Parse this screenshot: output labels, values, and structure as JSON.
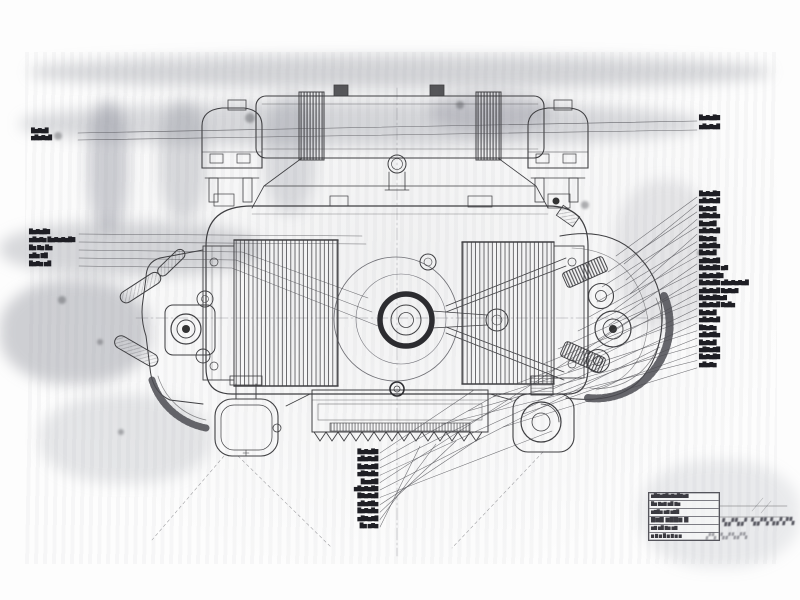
{
  "sheet": {
    "colors": {
      "paper": "#fdfdfd",
      "ink": "#3f3f42",
      "label_ink": "#1e1e24",
      "smudge": "#8c8f98"
    }
  },
  "annotations": {
    "left_top_labels": [
      "█▆▇▆█",
      "▆█▆▇▆█"
    ],
    "left_labels": [
      "█▆▇▆█▇",
      "▆█▆▇▆ █▆▇▆▇▆█▇",
      "█▆ ▇▆ █▆",
      "▆█▆ ▇█",
      "█▆▇▆ ▆█"
    ],
    "right_top_labels": [
      "█▆▇▆█▇",
      "▆█▆▇▆█"
    ],
    "right_labels": [
      "█▆▇▆█▇",
      "▆█▆▇▆█",
      "█▆▇▆▇",
      "▆█▇▆█▆",
      "█▆▆▇█",
      "▆█▆▇▆█",
      "█▇▆▇▆",
      "▆█▆▇█▆",
      "█▆▇▆█",
      "▆█▇▆▇█",
      "█▆▇▆█▇ ▆▇",
      "▆█▆▇▆█▇",
      "█▆▇▆█▇ ▆█▆▇▆▇▆█",
      "▆█▆▇▆█ ▇▆▇▆▇",
      "█▆▇▆█▇▆▇",
      "▆█▆▇▆█ ▇▆█▆",
      "█▆▇▆█",
      "▆█▆▇▆█",
      "█▇▆▇▆",
      "▆█▆▇█▆",
      "█▆▇▆█",
      "▆█▇▆▇█",
      "█▆▇▆█▇",
      "▆█▆▇▆"
    ],
    "bottom_labels": [
      "█▆▇▆█▇",
      "▆█▆▇▆█",
      "█▆▇▆▇█",
      "▆█▇▆█▆",
      "█▆▆▇█",
      "▆█▆▇▆█▇",
      "█▇▆▇▆█",
      "▆█▆▇█▆",
      "█▆▇▆█▆",
      "▆█▇▆▇█",
      "█▆ ▆▇▆"
    ]
  },
  "title_block": {
    "rows": [
      "▆█▇▆▇█▆▇▆█▇▆▇",
      "█▆ ▇▆▇ ▆█ ▇▆",
      "▆▇█▆ ▆▇ ▆▇█",
      "█▆▇ ▆█▇▆ ▇",
      "▆▇ ▆█ ▇▆ ▆▇",
      "▆ ▇ ▆ █ ▆ ▇ ▆ ▆"
    ],
    "note_right": "▚▞▚▞ ▚▞▚▚▞▞▚",
    "note_below": "▞▚ ▚▞▚▞▚"
  }
}
